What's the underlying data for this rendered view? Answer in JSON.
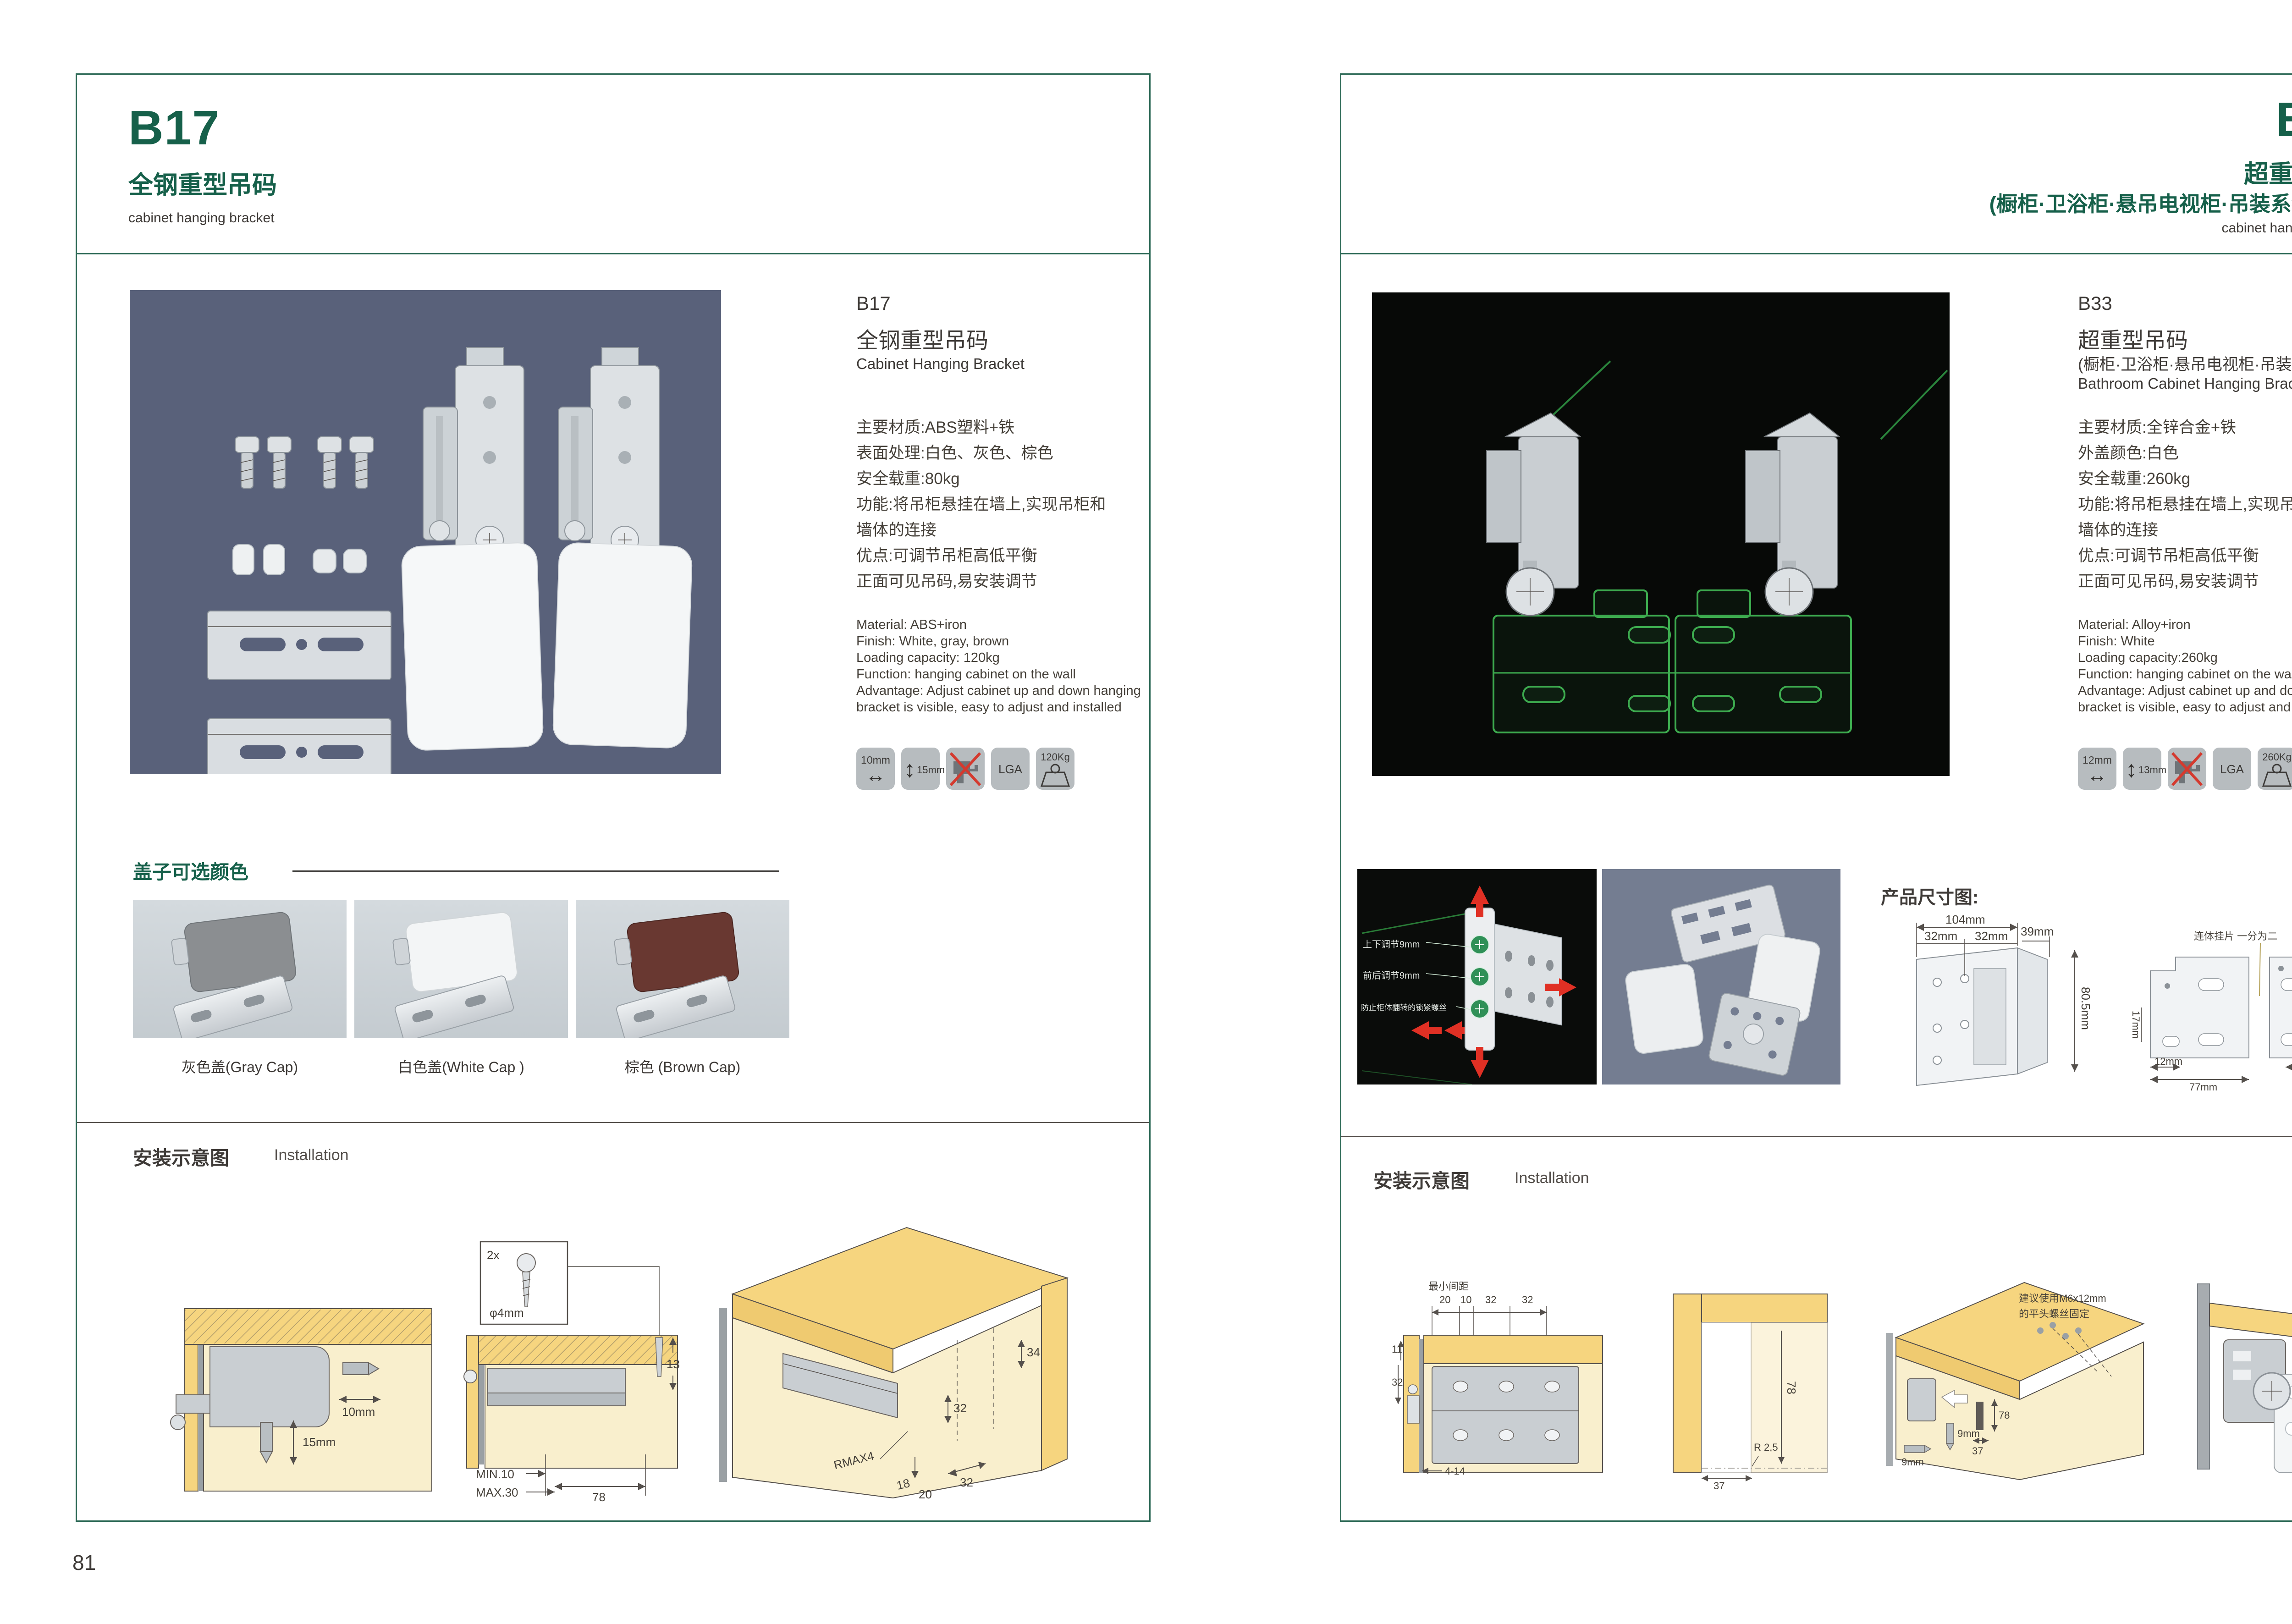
{
  "colors": {
    "brand_green": "#16604a",
    "frame_teal": "#2e6a57",
    "outline_green": "#3dab4f",
    "arrow_red": "#e03024"
  },
  "left": {
    "page_no": "81",
    "header": {
      "code": "B17",
      "name": "全钢重型吊码",
      "sub": "cabinet hanging bracket"
    },
    "info": {
      "code": "B17",
      "name": "全钢重型吊码",
      "name_en": "Cabinet Hanging Bracket",
      "cn": [
        "主要材质:ABS塑料+铁",
        "表面处理:白色、灰色、棕色",
        "安全载重:80kg",
        "功能:将吊柜悬挂在墙上,实现吊柜和",
        "墙体的连接",
        "优点:可调节吊柜高低平衡",
        "正面可见吊码,易安装调节"
      ],
      "en": [
        "Material: ABS+iron",
        "Finish: White, gray, brown",
        "Loading capacity: 120kg",
        "Function: hanging cabinet on the wall",
        "Advantage: Adjust cabinet up and down hanging",
        "bracket is visible, easy to adjust and installed"
      ],
      "icons": {
        "w": "10mm",
        "h": "15mm",
        "lga": "LGA",
        "load": "120Kg"
      }
    },
    "caps": {
      "title": "盖子可选颜色",
      "items": [
        "灰色盖(Gray Cap)",
        "白色盖(White Cap )",
        "棕色 (Brown Cap)"
      ],
      "swatches": [
        "#8b8e91",
        "#f3f5f6",
        "#693831"
      ]
    },
    "install": {
      "cn": "安装示意图",
      "en": "Installation"
    },
    "d1": {
      "w": "10mm",
      "h": "15mm"
    },
    "d2": {
      "qty": "2x",
      "dia": "φ4mm",
      "t": "13",
      "min": "MIN.10",
      "max": "MAX.30",
      "w": "78"
    },
    "d3": {
      "a": "34",
      "b": "32",
      "r": "RMAX4",
      "c": "18",
      "d": "20",
      "e": "32"
    }
  },
  "right": {
    "page_no": "82",
    "header": {
      "code": "B33",
      "name": "超重型吊码",
      "paren": "(橱柜·卫浴柜·悬吊电视柜·吊装系统 专用)",
      "sub": "cabinet hanging bracket"
    },
    "info": {
      "code": "B33",
      "name": "超重型吊码",
      "paren": "(橱柜·卫浴柜·悬吊电视柜·吊装系统 专用)",
      "name_en": "Bathroom Cabinet Hanging Bracket",
      "cn": [
        "主要材质:全锌合金+铁",
        "外盖颜色:白色",
        "安全载重:260kg",
        "功能:将吊柜悬挂在墙上,实现吊柜和",
        "墙体的连接",
        "优点:可调节吊柜高低平衡",
        "正面可见吊码,易安装调节"
      ],
      "en": [
        "Material: Alloy+iron",
        "Finish: White",
        "Loading capacity:260kg",
        "Function: hanging cabinet on the wall",
        "Advantage: Adjust cabinet up and down hanging",
        "bracket is visible, easy to adjust and installed"
      ],
      "icons": {
        "w": "12mm",
        "h": "13mm",
        "lga": "LGA",
        "load": "260Kg"
      }
    },
    "adjust": {
      "l1": "上下调节9mm",
      "l2": "前后调节9mm",
      "l3": "防止柜体翻转的锁紧螺丝"
    },
    "dims_title": "产品尺寸图:",
    "dimA": {
      "w": "104mm",
      "p1": "32mm",
      "p2": "32mm",
      "d": "39mm",
      "h": "80.5mm"
    },
    "dimB": {
      "note": "连体挂片 一分为二",
      "top": "55mm",
      "r1": "39mm",
      "r2": "55mm",
      "r3": "8mm",
      "l": "17mm",
      "b1": "12mm",
      "b2": "63mm",
      "b3": "77mm"
    },
    "install": {
      "cn": "安装示意图",
      "en": "Installation"
    },
    "r1": {
      "note": "最小间距",
      "a": "20",
      "b": "10",
      "c": "32",
      "d": "32",
      "e": "11",
      "f": "32",
      "g": "4-14"
    },
    "r2": {
      "a": "78",
      "b": "R 2,5",
      "c": "37"
    },
    "r3": {
      "n1": "建议使用M6x12mm",
      "n2": "的平头螺丝固定",
      "a": "78",
      "b": "37",
      "c": "9mm",
      "d": "9mm"
    }
  }
}
